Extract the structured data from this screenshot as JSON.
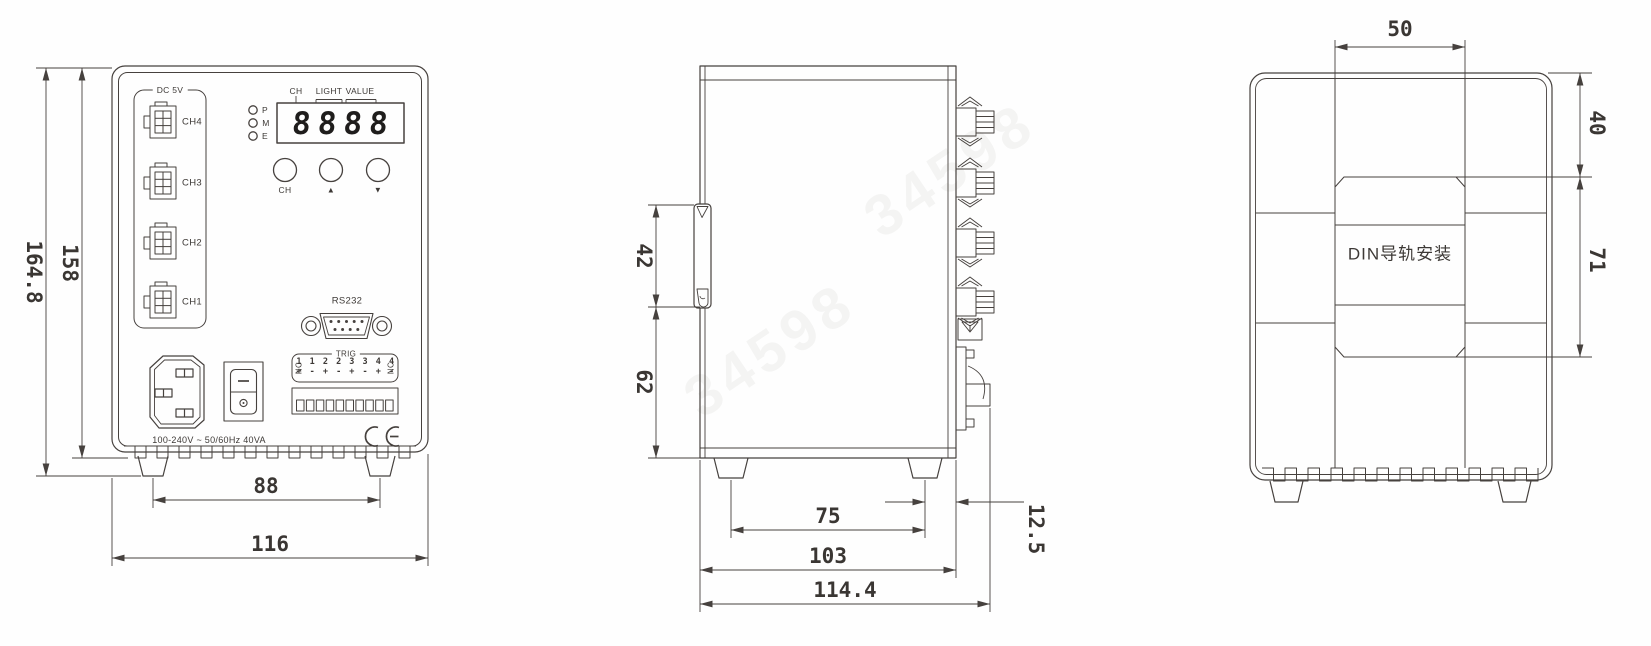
{
  "watermark": "34598",
  "front_view": {
    "connector_group": {
      "label": "DC 5V",
      "channels": [
        "CH4",
        "CH3",
        "CH2",
        "CH1"
      ]
    },
    "display": {
      "digits": "8888",
      "labels": {
        "ch": "CH",
        "light": "LIGHT",
        "value": "VALUE"
      },
      "leds": [
        "P",
        "M",
        "E"
      ]
    },
    "buttons": {
      "ch": "CH",
      "up": "▲",
      "down": "▼"
    },
    "rs232_label": "RS232",
    "trig": {
      "label": "TRIG",
      "nc_left": "NC",
      "numbers": "1 1 2 2 3 3 4 4",
      "signs": "+ - + - + - + -",
      "nc_right": "NC"
    },
    "power_rating": "100-240V ~ 50/60Hz 40VA",
    "dims": {
      "total_height": "164.8",
      "body_height": "158",
      "feet_pitch": "88",
      "total_width": "116"
    }
  },
  "side_view": {
    "dims": {
      "din_clip_height": "42",
      "clip_to_bottom": "62",
      "feet_pitch": "75",
      "body_depth": "103",
      "total_depth": "114.4",
      "rear_offset": "12.5"
    }
  },
  "back_view": {
    "din_mount_label": "DIN导轨安装",
    "dims": {
      "channel_width": "50",
      "top_to_pocket": "40",
      "pocket_height": "71"
    }
  }
}
